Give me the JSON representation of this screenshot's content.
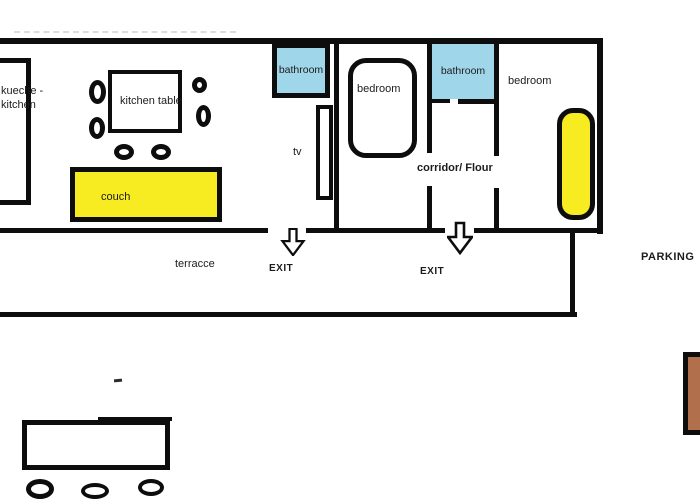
{
  "colors": {
    "wall": "#0d0d0d",
    "bathroom_fill": "#9fd6e9",
    "highlight_yellow": "#f7eb22",
    "brown": "#b26f4b"
  },
  "labels": {
    "kitchen_line1": "kueche -",
    "kitchen_line2": "kitchen",
    "kitchen_table": "kitchen table",
    "couch": "couch",
    "bathroom_left": "bathroom",
    "tv": "tv",
    "bedroom_left": "bedroom",
    "bathroom_right": "bathroom",
    "corridor": "corridor/ Flour",
    "bedroom_right": "bedroom",
    "terrace": "terracce",
    "exit_left": "EXIT",
    "exit_right": "EXIT",
    "parking": "PARKING"
  }
}
